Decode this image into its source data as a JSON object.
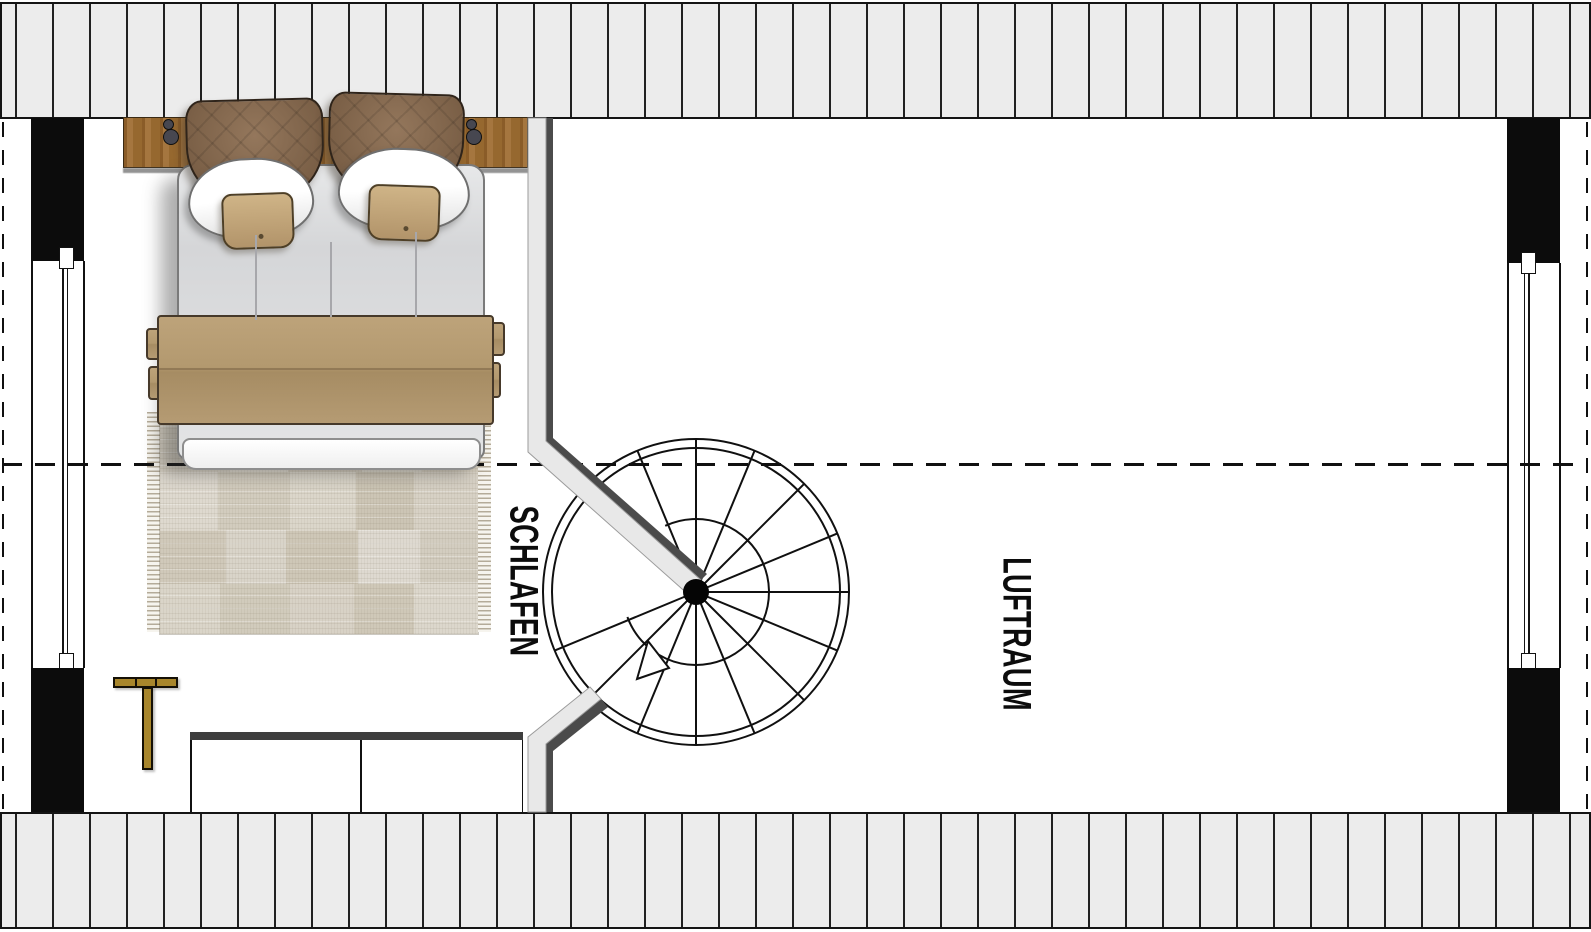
{
  "plan": {
    "room_labels": [
      {
        "id": "schlafen",
        "text": "SCHLAFEN"
      },
      {
        "id": "luftraum",
        "text": "LUFTRAUM"
      }
    ],
    "staircase": {
      "type": "spiral",
      "tread_lines": 13
    },
    "colors": {
      "roof_hatch_fill": "#ececec",
      "hatch_line": "#202020",
      "wall_black": "#0c0c0c",
      "stair_wall_gray": "#e8e8e8",
      "stair_wall_shadow": "#4b4b4b",
      "wood_headboard": "#9a6a35",
      "blanket_tan": "#b49b73",
      "pillow_brown": "#7e634a",
      "pillow_white": "#fafafa",
      "cushion_tan": "#c4a87c",
      "duvet_gray": "#dcdddf",
      "rug_base": "#d8d2c6",
      "valet_gold": "#a8862c",
      "railing_dark": "#3e3e3e"
    },
    "rug": {
      "patches": [
        {
          "l": 0,
          "t": 0,
          "w": 70,
          "h": 62,
          "c": "#d6d0c3"
        },
        {
          "l": 70,
          "t": 0,
          "w": 58,
          "h": 62,
          "c": "#ddd8cd"
        },
        {
          "l": 128,
          "t": 0,
          "w": 74,
          "h": 62,
          "c": "#cfc8b9"
        },
        {
          "l": 202,
          "t": 0,
          "w": 60,
          "h": 62,
          "c": "#d8d3c7"
        },
        {
          "l": 262,
          "t": 0,
          "w": 56,
          "h": 62,
          "c": "#d1cabb"
        },
        {
          "l": 0,
          "t": 62,
          "w": 58,
          "h": 58,
          "c": "#ded9cf"
        },
        {
          "l": 58,
          "t": 62,
          "w": 72,
          "h": 58,
          "c": "#d2ccbe"
        },
        {
          "l": 130,
          "t": 62,
          "w": 66,
          "h": 58,
          "c": "#dbd6ca"
        },
        {
          "l": 196,
          "t": 62,
          "w": 58,
          "h": 58,
          "c": "#ccc5b5"
        },
        {
          "l": 254,
          "t": 62,
          "w": 64,
          "h": 58,
          "c": "#d7d1c5"
        },
        {
          "l": 0,
          "t": 120,
          "w": 66,
          "h": 54,
          "c": "#d0c9ba"
        },
        {
          "l": 66,
          "t": 120,
          "w": 60,
          "h": 54,
          "c": "#d9d4c9"
        },
        {
          "l": 126,
          "t": 120,
          "w": 72,
          "h": 54,
          "c": "#cec7b7"
        },
        {
          "l": 198,
          "t": 120,
          "w": 62,
          "h": 54,
          "c": "#ded9d0"
        },
        {
          "l": 260,
          "t": 120,
          "w": 58,
          "h": 54,
          "c": "#d3cdc0"
        },
        {
          "l": 0,
          "t": 174,
          "w": 60,
          "h": 50,
          "c": "#dad5c9"
        },
        {
          "l": 60,
          "t": 174,
          "w": 70,
          "h": 50,
          "c": "#d1cbbc"
        },
        {
          "l": 130,
          "t": 174,
          "w": 64,
          "h": 50,
          "c": "#d8d2c6"
        },
        {
          "l": 194,
          "t": 174,
          "w": 60,
          "h": 50,
          "c": "#cfc8b8"
        },
        {
          "l": 254,
          "t": 174,
          "w": 64,
          "h": 50,
          "c": "#dcd7cc"
        }
      ]
    }
  }
}
